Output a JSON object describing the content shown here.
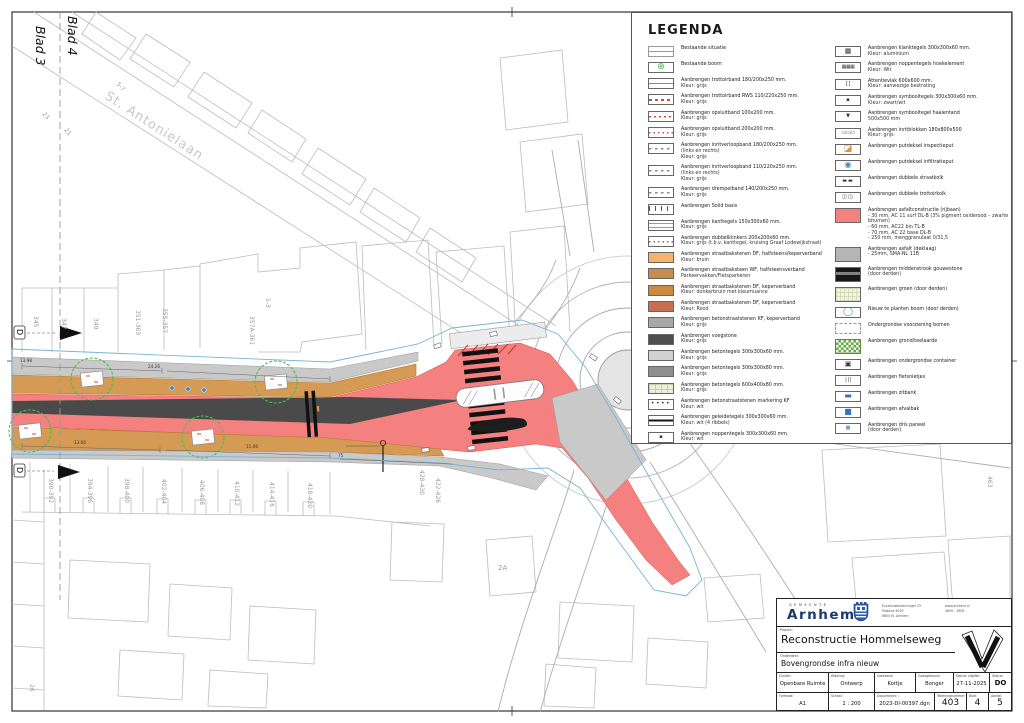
{
  "colors": {
    "red_asphalt": "#f4807f",
    "tan_brick": "#d59a54",
    "sidewalk_gray": "#c9c9c9",
    "median_dark": "#4a4a4a",
    "tree_green": "#46c24e",
    "boundary_blue": "#7ab3d4",
    "cadastral_gray": "#bcbcbc",
    "brand_navy": "#1b3a6b",
    "manhole_orange": "#e69138",
    "manhole_blue": "#3d85c8"
  },
  "map": {
    "blad4": "Blad 4",
    "blad3": "Blad 3",
    "street_label": "St. Antonielaan",
    "section_marker": "D",
    "parcels_north": [
      "345",
      "347",
      "349",
      "351-363",
      "355-357",
      "357A-361",
      "1-3"
    ],
    "parcels_south": [
      "390-392",
      "394-396",
      "398-400",
      "402-404",
      "406-408",
      "410-412",
      "414-416",
      "418-420",
      "428-430",
      "422-426"
    ],
    "misc": {
      "p2a": "2A",
      "p463": "463",
      "p26": "26",
      "p23": "23",
      "p21": "21",
      "p57": "5-7"
    },
    "dims": {
      "d1": "13.98",
      "d2": "24.26",
      "d3": "13.06",
      "d4": "11.06",
      "d5": "75"
    }
  },
  "legend": {
    "title": "LEGENDA",
    "left": [
      {
        "t": "Bestaande situatie",
        "sw": "sw-exist",
        "n": "existing-situation-swatch"
      },
      {
        "t": "Bestaande boom",
        "sw": "sw-extree",
        "g": "⊕",
        "n": "existing-tree-icon"
      },
      {
        "t": "Aanbrengen trottoirband 180/200x250 mm.",
        "sub": [
          "Kleur: grijs"
        ],
        "sw": "sw-band"
      },
      {
        "t": "Aanbrengen trottoirband RWS 110/220x250 mm.",
        "sub": [
          "Kleur: grijs"
        ],
        "sw": "sw-band-rd"
      },
      {
        "t": "Aanbrengen opsluitband 100x200 mm.",
        "sub": [
          "Kleur: grijs"
        ],
        "sw": "sw-band-rd2"
      },
      {
        "t": "Aanbrengen opsluitband 200x200 mm.",
        "sub": [
          "Kleur: grijs"
        ],
        "sw": "sw-band-dot"
      },
      {
        "t": "Aanbrengen inritverloopband 180/200x250 mm.",
        "sub": [
          "(links en rechts)",
          "Kleur: grijs"
        ],
        "sw": "sw-band-in"
      },
      {
        "t": "Aanbrengen inritverloopband 110/220x250 mm.",
        "sub": [
          "(links en rechts)",
          "Kleur: grijs"
        ],
        "sw": "sw-band-in"
      },
      {
        "t": "Aanbrengen drempelband 140/200x250 mm.",
        "sub": [
          "Kleur: grijs"
        ],
        "sw": "sw-band-in"
      },
      {
        "t": "Aanbrengen Solid basis",
        "sw": "sw-solid"
      },
      {
        "t": "Aanbrengen kanttegels 150x300x60 mm.",
        "sub": [
          "Kleur: grijs"
        ],
        "sw": "sw-band2"
      },
      {
        "t": "Aanbrengen dubbelklinkers 200x200x60 mm.",
        "sub": [
          "Kleur: grijs (t.b.v. kanttegel, kruising Graaf Lodewijkstraat)"
        ],
        "sw": "sw-band-dot"
      },
      {
        "t": "Aanbrengen straatbakstenen DF, halfsteens/keperverband",
        "sub": [
          "Kleur: bruin"
        ],
        "c": "#f6b26b"
      },
      {
        "t": "Aanbrengen straatbaksteen WF, halfsteensverband",
        "sub": [
          "Parkeervakken/Fietsparkeren"
        ],
        "c": "#c98c4e"
      },
      {
        "t": "Aanbrengen straatbakstenen DF, keperverband",
        "sub": [
          "Kleur: donkerbruin met kleurnuance"
        ],
        "c": "#cf8a42"
      },
      {
        "t": "Aanbrengen straatbakstenen DF, keperverband",
        "sub": [
          "Kleur: Rood"
        ],
        "c": "#c96f52"
      },
      {
        "t": "Aanbrengen betonstraatstenen KF, keperverband",
        "sub": [
          "Kleur: grijs"
        ],
        "c": "#a8a8a8"
      },
      {
        "t": "Aanbrengen voegstone",
        "sub": [
          "Kleur: grijs"
        ],
        "c": "#4f4f4f"
      },
      {
        "t": "Aanbrengen betontegels 300x300x60 mm.",
        "sub": [
          "Kleur: grijs"
        ],
        "c": "#d2d2d2"
      },
      {
        "t": "Aanbrengen betontegels 300x300x80 mm.",
        "sub": [
          "Kleur: grijs"
        ],
        "c": "#8f8f8f"
      },
      {
        "t": "Aanbrengen betontegels 600x400x80 mm.",
        "sub": [
          "Kleur: grijs"
        ],
        "sw": "sw-tegel600"
      },
      {
        "t": "Aanbrengen betonstraatstenen markering KF",
        "sub": [
          "Kleur: wit"
        ],
        "sw": "sw-dots",
        "g": "••••"
      },
      {
        "t": "Aanbrengen geleidetegels 300x300x60 mm.",
        "sub": [
          "Kleur: wit (4 ribbels)"
        ],
        "sw": "sw-guide"
      },
      {
        "t": "Aanbrengen noppentegels 300x300x60 mm.",
        "sub": [
          "Kleur: wit"
        ],
        "sw": "sw-nop",
        "g": "▪"
      }
    ],
    "right": [
      {
        "t": "Aanbrengen klanktegels 300x300x60 mm.",
        "sub": [
          "Kleur: aluminium"
        ],
        "sw": "sw-ic",
        "g": "▦"
      },
      {
        "t": "Aanbrengen noppentegels hoekelement",
        "sub": [
          "Kleur: Wit"
        ],
        "sw": "sw-ic sw-sm",
        "g": "▦▦▦"
      },
      {
        "t": "Attentievlak 600x600 mm.",
        "sub": [
          "Kleur: aanwezige bestrating"
        ],
        "sw": "sw-ic sw-sm",
        "g": "[ ]"
      },
      {
        "t": "Aanbrengen symbooltegels 300x300x60 mm.",
        "sub": [
          "Kleur: zwart/wit"
        ],
        "sw": "sw-ic sw-sm2",
        "g": "▪"
      },
      {
        "t": "Aanbrengen symbooltegel haaientand",
        "sub": [
          "500x500 mm"
        ],
        "sw": "sw-ic sw-sm2",
        "g": "▼"
      },
      {
        "t": "Aanbrengen inritblokken 180x800x500",
        "sub": [
          "Kleur: grijs"
        ],
        "sw": "sw-ic sw-sm",
        "g": "▭▭▭"
      },
      {
        "t": "Aanbrengen putdeksel inspectieput",
        "sw": "sw-ic sw-orange",
        "g": "◪",
        "n": "inspection-manhole-icon"
      },
      {
        "t": "Aanbrengen putdeksel infiltratieput",
        "sw": "sw-ic sw-blue",
        "g": "◉",
        "n": "infiltration-manhole-icon"
      },
      {
        "t": "Aanbrengen dubbele straatkolk",
        "sw": "sw-ic sw-dark",
        "g": "▬▬"
      },
      {
        "t": "Aanbrengen dubbele trottoirkolk",
        "sw": "sw-ic sw-dark",
        "g": "◫◫"
      },
      {
        "t": "Aanbrengen asfaltconstructie (rijbaan)",
        "sub": [
          "- 30 mm, AC 11 surf DL-B (3% pigment oxiderood – zwarte bitumen)",
          "- 60 mm, AC22 bin TL-B",
          "- 70 mm, AC 22 base DL-B",
          "- 250 mm, menggranulaat 0/31,5"
        ],
        "c": "#f4807f",
        "sw": "tall",
        "n": "asphalt-swatch"
      },
      {
        "t": "Aanbrengen asfalt (deklaag)",
        "sub": [
          "- 25mm, SMA-NL 11B"
        ],
        "c": "#b5b5b5",
        "sw": "tall"
      },
      {
        "t": "Aanbrengen middenstrook gouwestone",
        "sub": [
          "(door derden)"
        ],
        "sw": "sw-midden tall"
      },
      {
        "t": "Aanbrengen groen (door derden)",
        "sw": "sw-groen tall"
      },
      {
        "t": "Nieuw te planten boom (door derden)",
        "sw": "sw-ic sw-greeng",
        "g": "◯",
        "n": "new-tree-icon"
      },
      {
        "t": "Ondergrondse voorziening bomen",
        "sw": "sw-dashtop"
      },
      {
        "t": "Aanbrengen grond/teelaarde",
        "sw": "sw-grond tall"
      },
      {
        "t": "Aanbrengen ondergrondse container",
        "sw": "sw-ic",
        "g": "▣"
      },
      {
        "t": "Aanbrengen fietsnietjes",
        "sw": "sw-ic sw-sm",
        "g": "| | |"
      },
      {
        "t": "Aanbrengen zitbank",
        "sw": "sw-ic sw-bluet",
        "g": "▬"
      },
      {
        "t": "Aanbrengen afvalbak",
        "sw": "sw-ic sw-bluet sw-sm2",
        "g": "■"
      },
      {
        "t": "Aanbrengen dris paneel",
        "sub": [
          "(door derden)"
        ],
        "sw": "sw-ic sw-bluel sw-sm2",
        "g": "■"
      }
    ]
  },
  "titleblock": {
    "gemeente": "GEMEENTE",
    "municipality": "Arnhem",
    "address_lines": [
      "Eusebiusbuitensingel 53",
      "Postbus 9029",
      "6800 EL Arnhem"
    ],
    "contact_lines": [
      "www.arnhem.nl",
      "0800 - 1809"
    ],
    "project_label": "Project:",
    "project": "Reconstructie Hommelseweg",
    "onderdeel_label": "Onderdeel:",
    "onderdeel": "Bovengrondse infra nieuw",
    "fields": [
      {
        "label": "Cluster:",
        "value": "Openbare Ruimte"
      },
      {
        "label": "Afdeling:",
        "value": "Ontwerp"
      },
      {
        "label": "Getekend:",
        "value": "Kortje"
      },
      {
        "label": "Goedgekeurd:",
        "value": "Bonger"
      },
      {
        "label": "Datum uitgifte:",
        "value": "27-11-2025"
      },
      {
        "label": "Status:",
        "value": "DO"
      },
      {
        "label": "Formaat:",
        "value": "A1"
      },
      {
        "label": "Schaal:",
        "value": "1 : 200"
      },
      {
        "label": "Documentnr.:",
        "value": "2023-DI-00397.dgn"
      },
      {
        "label": "Tekeningnummer:",
        "value": "403"
      },
      {
        "label": "Blad:",
        "value": "4"
      },
      {
        "label": "Aantal:",
        "value": "5"
      }
    ]
  }
}
